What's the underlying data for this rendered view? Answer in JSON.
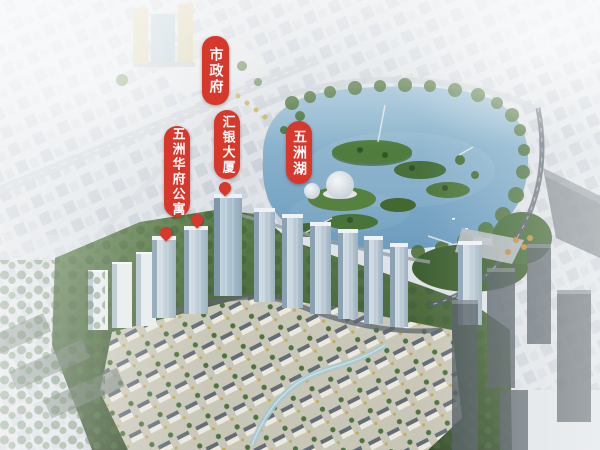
{
  "annotations": {
    "city_government": "市政府",
    "huiyin_tower": "汇银大厦",
    "wuzhou_huafu_apartments": "五洲华府公寓",
    "wuzhou_lake": "五洲湖"
  },
  "colors": {
    "label_red": "#d8382b",
    "label_text": "#ffffff",
    "lake_top": "#9abfd4",
    "lake_bottom": "#6c9cbe",
    "tree_green": "#4e7339",
    "site_green_dark": "#384f2d",
    "villa_roof": "#646d75",
    "villa_wall": "#ece9df",
    "city_haze": "#dfe3e7",
    "glass_tower_light": "#d6e0e7",
    "glass_tower_dark": "#9cb2c0",
    "gov_facade": "#d8cfa9",
    "dark_phase_tower": "#4e585e"
  }
}
